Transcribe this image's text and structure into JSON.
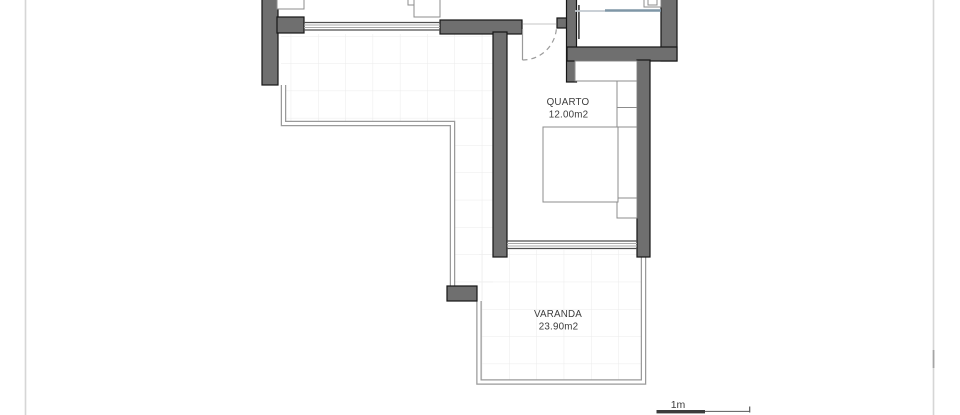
{
  "plan": {
    "rooms": [
      {
        "id": "quarto",
        "name": "QUARTO",
        "area": "12.00m2"
      },
      {
        "id": "varanda",
        "name": "VARANDA",
        "area": "23.90m2"
      }
    ],
    "scale": {
      "label": "1m"
    }
  },
  "colors": {
    "wall_fill": "#6f6f6f",
    "wall_outline": "#161616",
    "grid_line": "#ebebeb",
    "railing": "#9a9a9a",
    "furniture_outline": "#8c8c8c",
    "glass_dark": "#7f96a6",
    "glass_light": "#c3cad0",
    "door_arc": "#9c9c9c",
    "label_text": "#3d3d3d",
    "scale_bar": "#3c3c3c",
    "page_edge": "#d6d6d6"
  }
}
